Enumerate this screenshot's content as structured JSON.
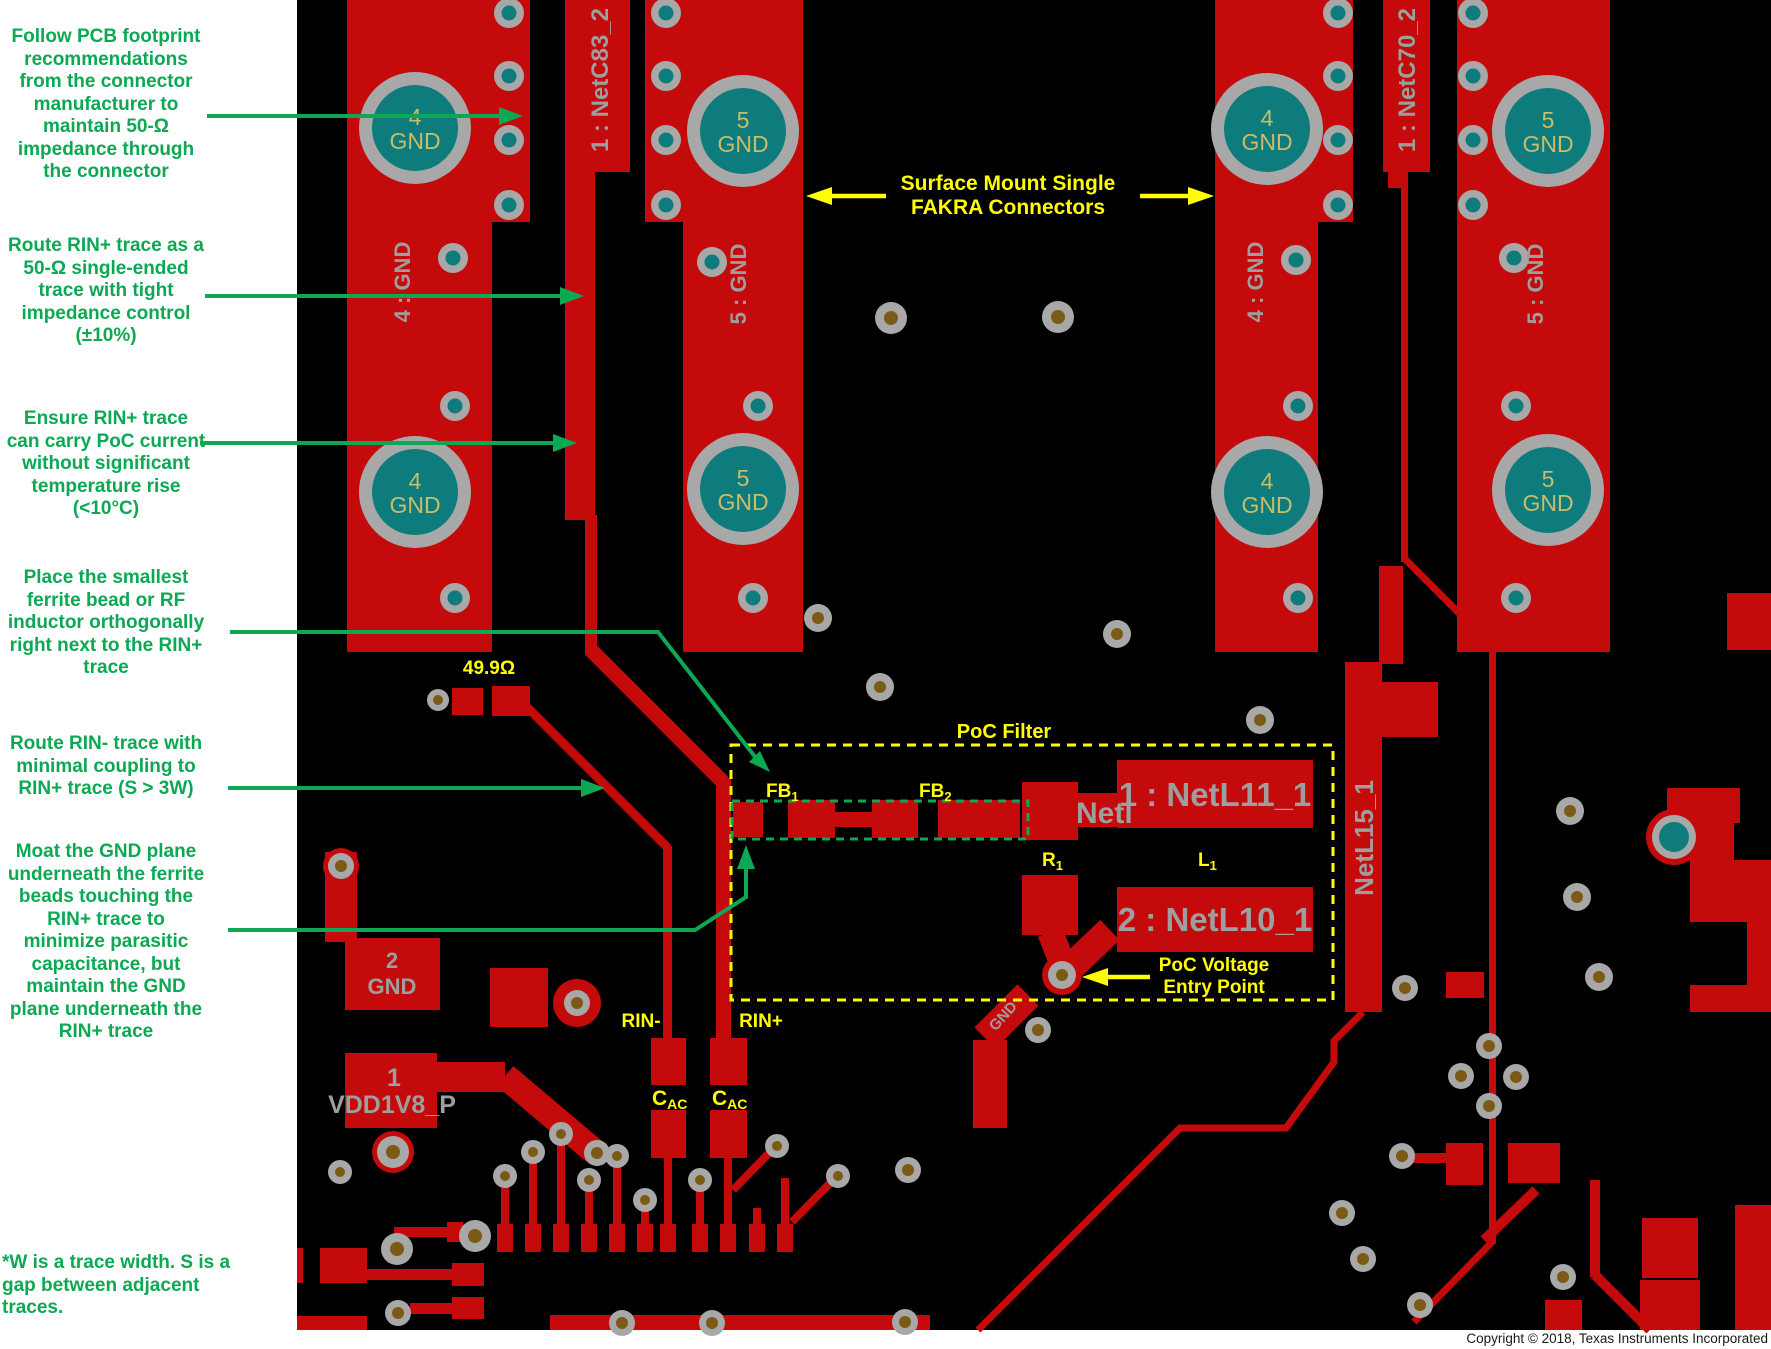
{
  "colors": {
    "copper": "#C40A0A",
    "board": "#000000",
    "pad_ring_gray": "#A8A8A8",
    "pad_teal": "#0E7C7C",
    "drill_olive": "#7A5A14",
    "board_text_gray": "#9E9E9E",
    "board_text_khaki": "#C9BC6A",
    "annotation_green": "#0CA853",
    "annotation_yellow": "#FEFE00"
  },
  "annotations": {
    "follow_pcb": "Follow PCB footprint\nrecommendations\nfrom the connector\nmanufacturer to\nmaintain 50-Ω\nimpedance through\nthe connector",
    "route_rin_plus": "Route RIN+ trace as a\n50-Ω single-ended\ntrace with tight\nimpedance control\n(±10%)",
    "ensure_rin_plus": "Ensure RIN+ trace\ncan carry PoC current\nwithout significant\ntemperature rise\n(<10°C)",
    "place_ferrite": "Place the smallest\nferrite bead or RF\ninductor orthogonally\nright next to  the RIN+\ntrace",
    "route_rin_minus": "Route RIN- trace with\nminimal coupling to\nRIN+ trace (S > 3W)",
    "moat_gnd": "Moat the GND plane\nunderneath the ferrite\nbeads touching the\nRIN+ trace to\nminimize parasitic\ncapacitance, but\nmaintain the GND\nplane underneath the\nRIN+ trace",
    "footnote": "*W is a trace width.  S is a\ngap between adjacent\ntraces."
  },
  "callouts": {
    "fakra1": "Surface Mount Single",
    "fakra2": "FAKRA Connectors",
    "resistor_value": "49.9Ω",
    "poc_filter": "PoC Filter",
    "fb": "FB",
    "fb1_sub": "1",
    "fb2_sub": "2",
    "r": "R",
    "r_sub": "1",
    "l": "L",
    "l_sub": "1",
    "rin_minus": "RIN-",
    "rin_plus": "RIN+",
    "cac": "C",
    "cac_sub": "AC",
    "poc_entry1": "PoC Voltage",
    "poc_entry2": "Entry Point"
  },
  "board_labels": {
    "netc83": "1 : NetC83_2",
    "netc70": "1 : NetC70_2",
    "gnd4_vert": "4 : GND",
    "gnd5_vert": "5 : GND",
    "netl15": "NetL15_1",
    "netl11": "1 : NetL11_1",
    "netl10": "2 : NetL10_1",
    "netl_partial": "Netl",
    "pin4": "4",
    "pin5": "5",
    "gnd": "GND",
    "pad2_pin": "2",
    "pad2_name": "GND",
    "pad1_pin": "1",
    "pad1_name": "VDD1V8_P",
    "gnd_small": "GND"
  },
  "footer": {
    "copyright": "Copyright © 2018, Texas Instruments Incorporated"
  }
}
